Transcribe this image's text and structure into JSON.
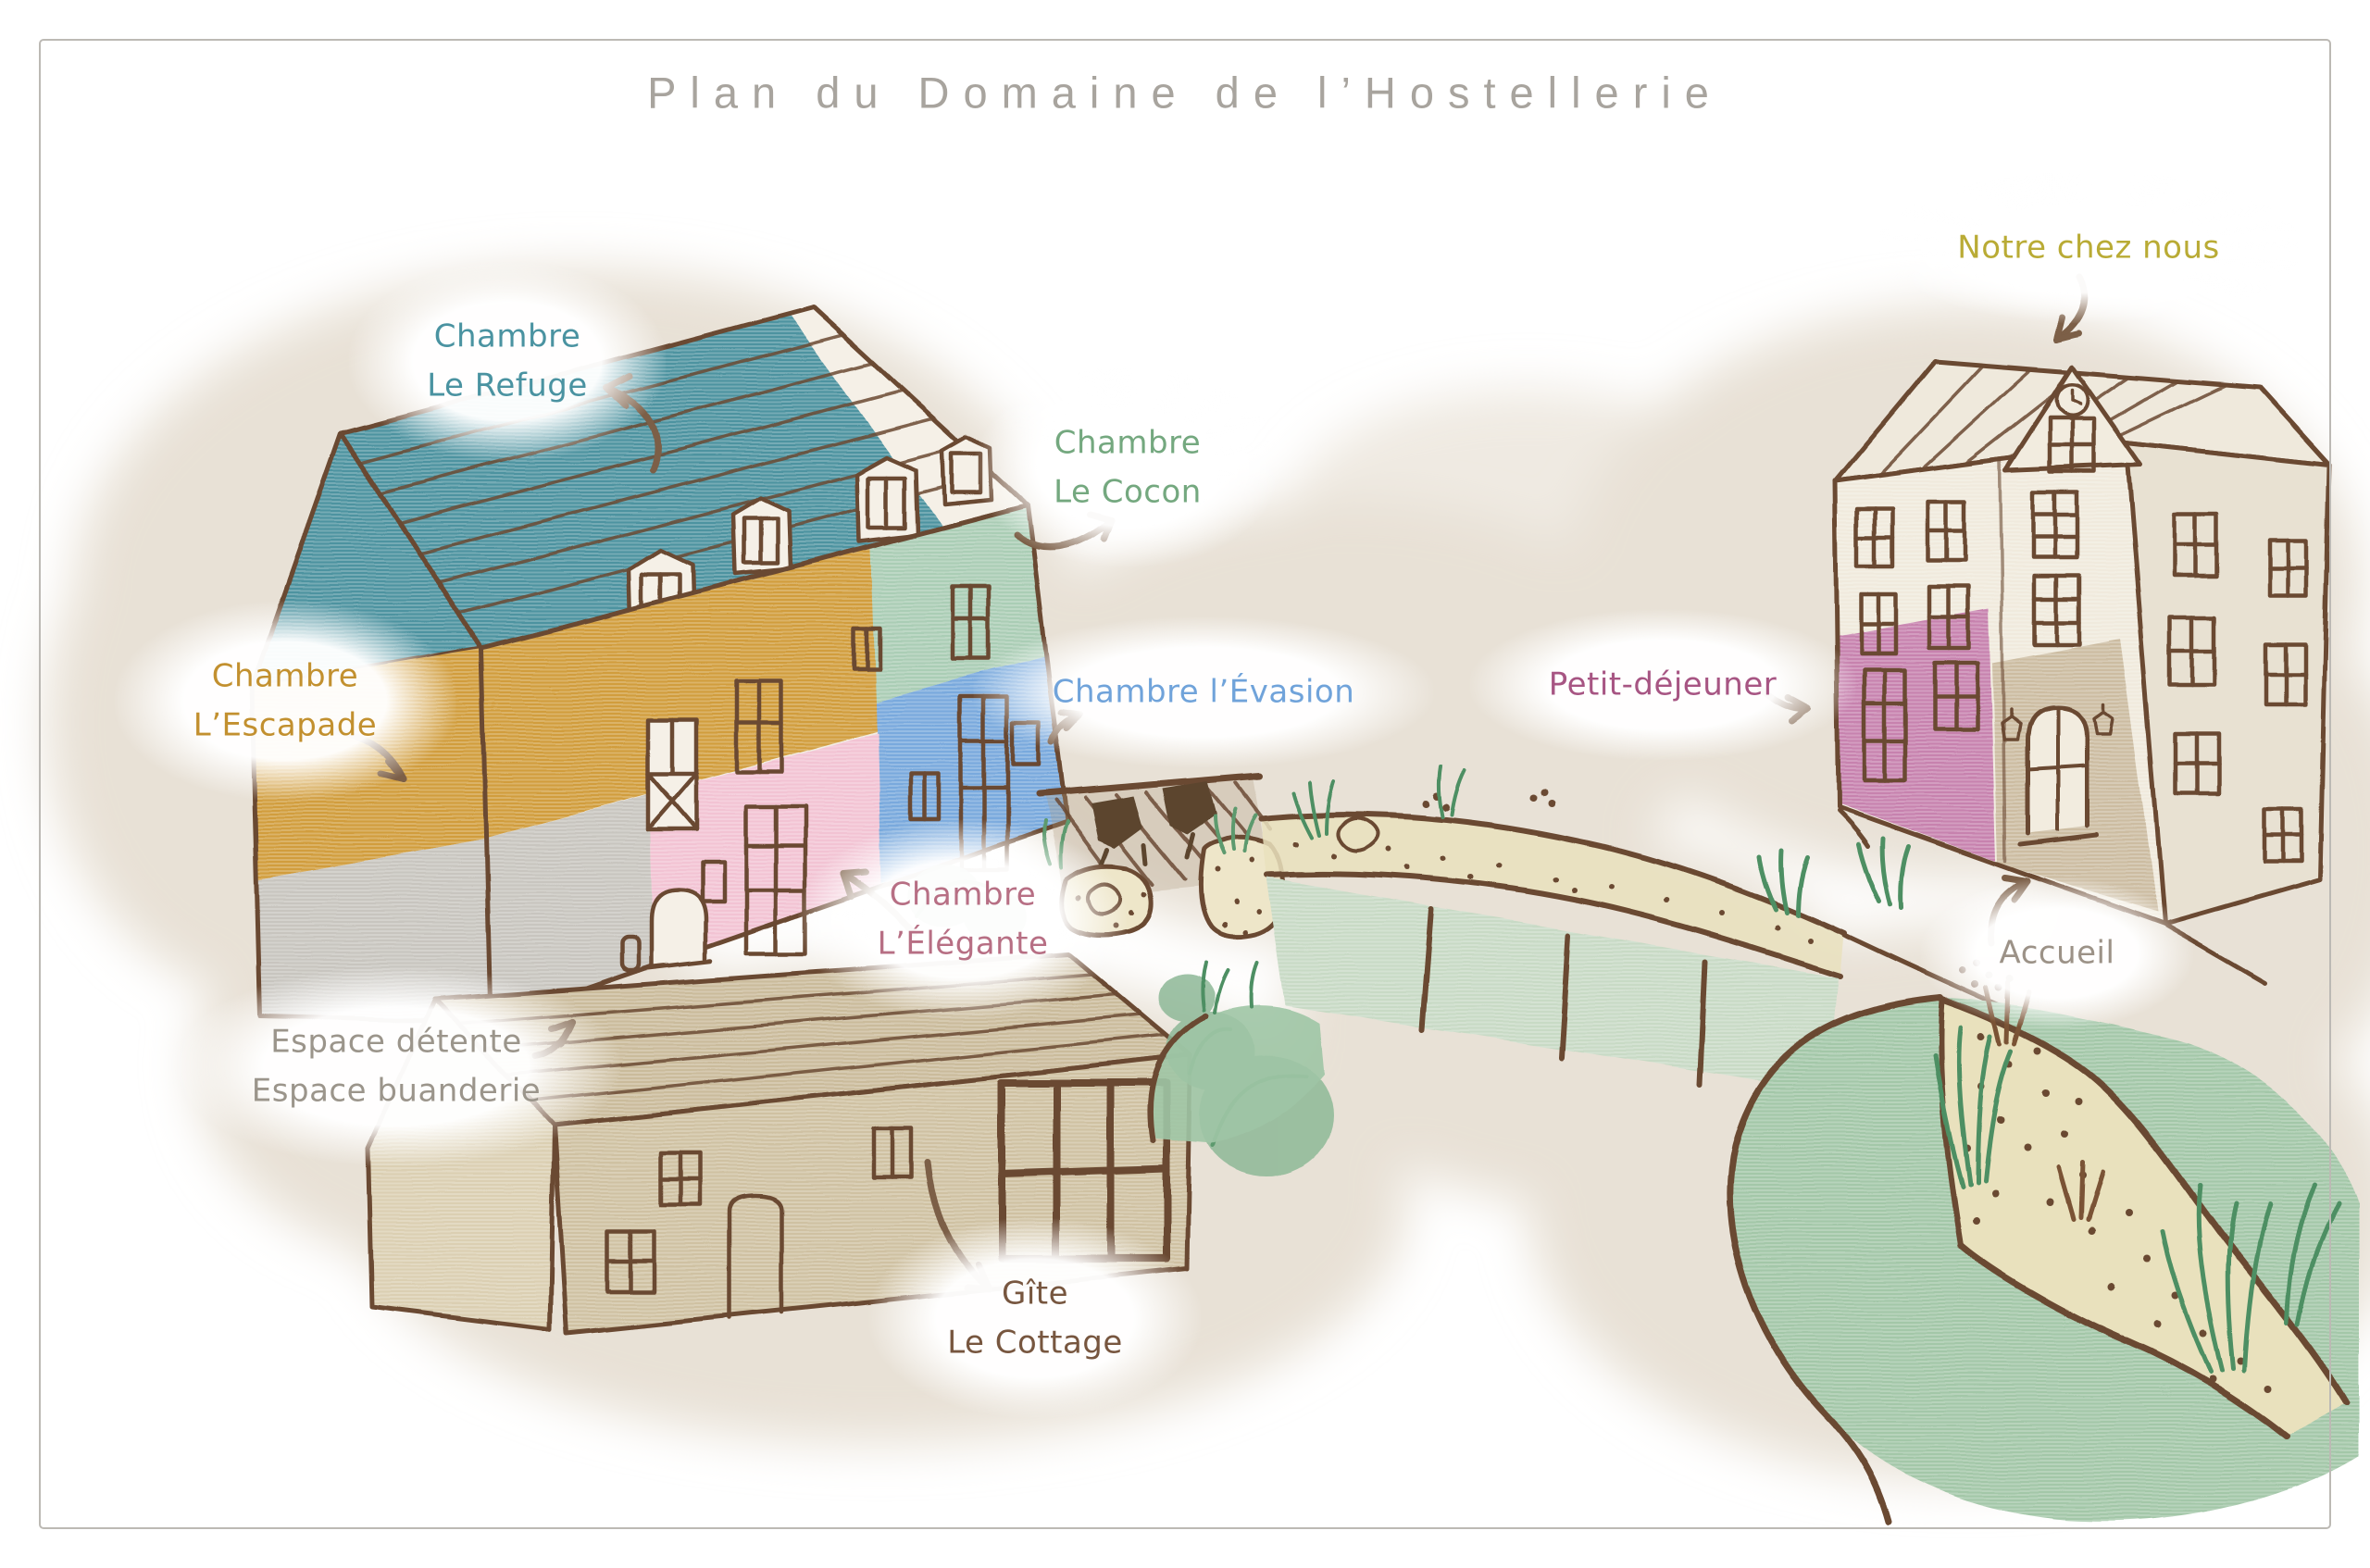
{
  "title": "Plan du Domaine de l’Hostellerie",
  "labels": {
    "refuge": {
      "line1": "Chambre",
      "line2": "Le Refuge",
      "color": "#4a93a1"
    },
    "cocon": {
      "line1": "Chambre",
      "line2": "Le Cocon",
      "color": "#74a87f"
    },
    "escapade": {
      "line1": "Chambre",
      "line2": "L’Escapade",
      "color": "#c2902f"
    },
    "evasion": {
      "line1": "Chambre l’Évasion",
      "color": "#70a3da"
    },
    "elegante": {
      "line1": "Chambre",
      "line2": "L’Élégante",
      "color": "#b76f84"
    },
    "espace": {
      "line1": "Espace détente",
      "line2": "Espace buanderie",
      "color": "#9b958b"
    },
    "gite": {
      "line1": "Gîte",
      "line2": "Le Cottage",
      "color": "#77563f"
    },
    "notre_chez_nous": {
      "line1": "Notre chez nous",
      "color": "#b9ab35"
    },
    "petit_dejeuner": {
      "line1": "Petit-déjeuner",
      "color": "#a75583"
    },
    "accueil": {
      "line1": "Accueil",
      "color": "#9c9287"
    }
  },
  "palette": {
    "title_color": "#a8a49e",
    "outline": "#6b4a33",
    "wash": "#e8e1d6",
    "roof_teal": "#4d93a0",
    "wall_gold": "#d19d3e",
    "wall_gray": "#c8c5bf",
    "wall_pink": "#f2c3d3",
    "wall_mint": "#aacdb5",
    "wall_blue": "#79a9dd",
    "cottage_tan": "#cfc1a2",
    "cottage_roof": "#cabb9b",
    "hotel_wall": "#f0eadd",
    "hotel_pink": "#c782ae",
    "hotel_tan": "#c8b79a",
    "lawn_green": "#a3c7a8",
    "parking_green": "#c8dac5",
    "sand": "#e9e1bd"
  }
}
